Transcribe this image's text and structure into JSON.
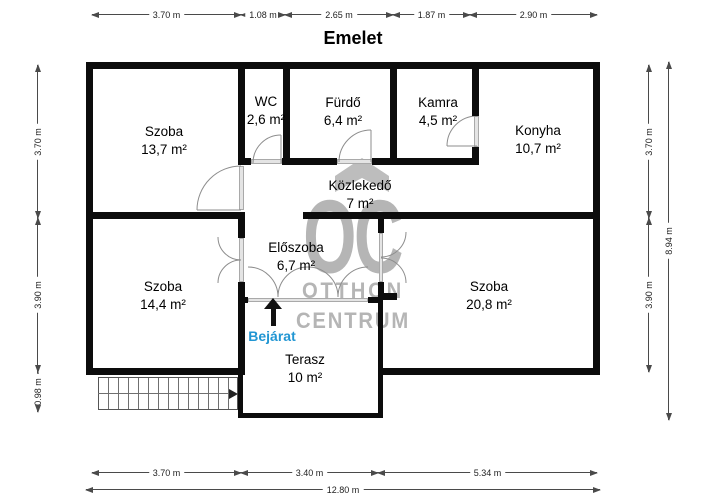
{
  "title": "Emelet",
  "entrance_label": "Bejárat",
  "watermark": {
    "monogram": "OC",
    "line1": "OTTHON",
    "line2": "CENTRUM"
  },
  "rooms": {
    "szoba1": {
      "name": "Szoba",
      "area": "13,7 m²"
    },
    "wc": {
      "name": "WC",
      "area": "2,6 m²"
    },
    "furdo": {
      "name": "Fürdő",
      "area": "6,4 m²"
    },
    "kamra": {
      "name": "Kamra",
      "area": "4,5 m²"
    },
    "konyha": {
      "name": "Konyha",
      "area": "10,7 m²"
    },
    "kozlekedo": {
      "name": "Közlekedő",
      "area": "7 m²"
    },
    "eloszoba": {
      "name": "Előszoba",
      "area": "6,7 m²"
    },
    "szoba2": {
      "name": "Szoba",
      "area": "14,4 m²"
    },
    "szoba3": {
      "name": "Szoba",
      "area": "20,8 m²"
    },
    "terasz": {
      "name": "Terasz",
      "area": "10 m²"
    }
  },
  "dimensions": {
    "top": [
      "3.70 m",
      "1.08 m",
      "2.65 m",
      "1.87 m",
      "2.90 m"
    ],
    "bottom": [
      "3.70 m",
      "3.40 m",
      "5.34 m"
    ],
    "bottom_total": "12.80 m",
    "left": [
      "3.70 m",
      "3.90 m",
      "0.98 m"
    ],
    "right": [
      "3.70 m",
      "3.90 m"
    ],
    "right_total": "8.94 m"
  },
  "colors": {
    "wall": "#0c0c0c",
    "window": "#c9c9c9",
    "entrance_text": "#2196d3",
    "watermark": "#b5b5b5"
  }
}
